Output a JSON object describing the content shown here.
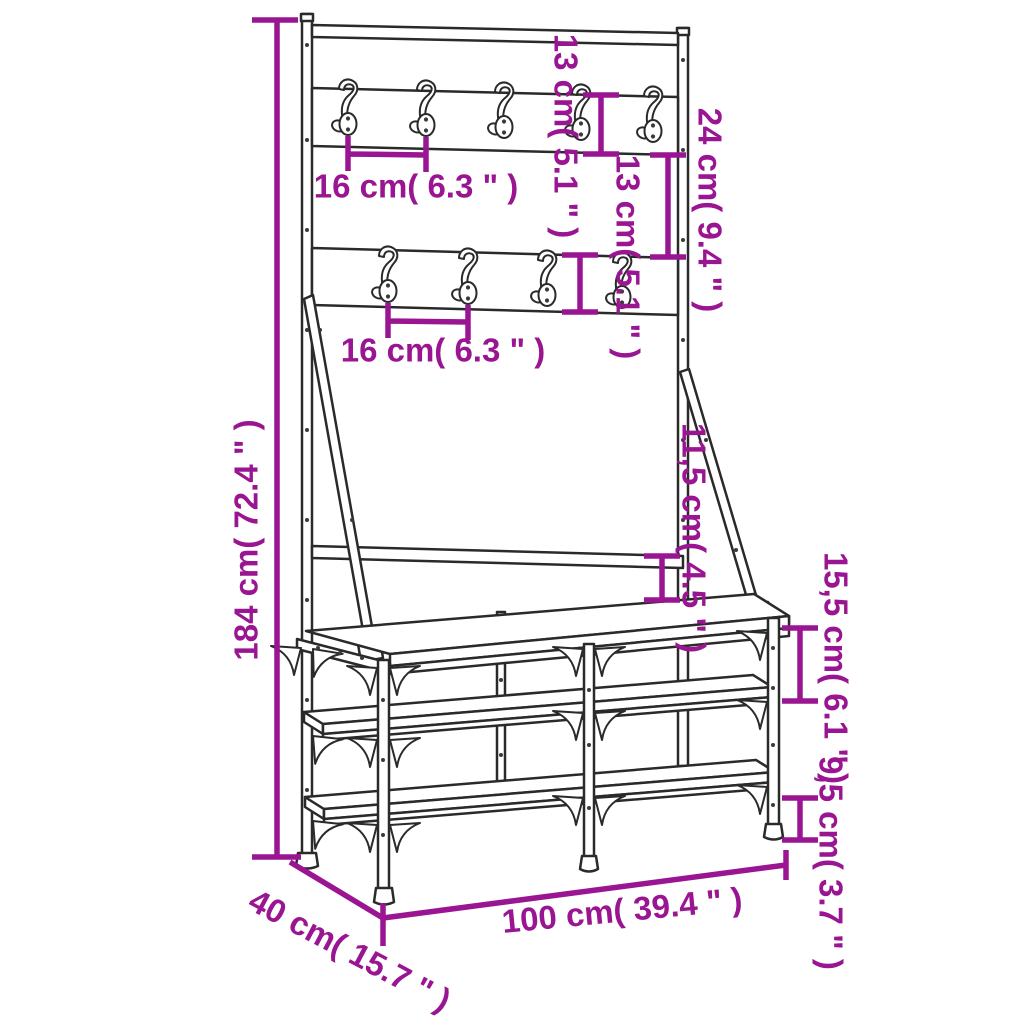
{
  "diagram": {
    "subject": "clothes rack with shoe storage bench",
    "accent_color": "#9A1591",
    "line_color": "#2a2a2a",
    "hook_row1_count": 5,
    "hook_row2_count": 4,
    "dimensions": {
      "height": "184 cm( 72.4 \" )",
      "hook_spacing_row1": "16 cm( 6.3 \" )",
      "board1_height": "13 cm( 5.1 \" )",
      "board_gap": "24 cm( 9.4 \" )",
      "board2_height": "13 cm( 5.1 \" )",
      "hook_spacing_row2": "16 cm( 6.3 \" )",
      "rail_to_bench": "11,5 cm( 4.5 \" )",
      "bench_to_shelf": "15,5 cm( 6.1 \" )",
      "shelf_to_floor": "9,5 cm( 3.7 \" )",
      "width": "100 cm( 39.4 \" )",
      "depth": "40 cm( 15.7 \" )"
    }
  }
}
